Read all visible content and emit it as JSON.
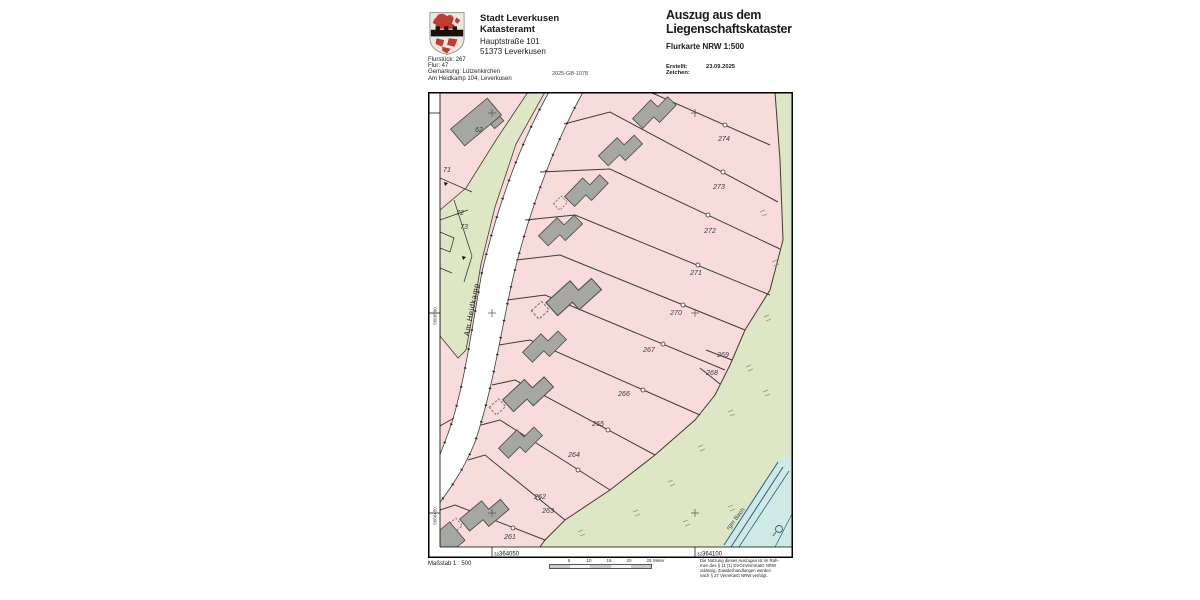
{
  "header": {
    "logo_name": "leverkusen-coat-of-arms",
    "org_line1": "Stadt Leverkusen",
    "org_line2": "Katasteramt",
    "address_line1": "Hauptstraße 101",
    "address_line2": "51373 Leverkusen",
    "info_line1": "Flurstück: 267",
    "info_line2": "Flur: 47",
    "info_line3": "Gemarkung: Lützenkirchen",
    "info_line4": "Am Heidkamp 104, Leverkusen",
    "doc_number": "2025-GB-1078",
    "title_line1": "Auszug aus dem",
    "title_line2": "Liegenschaftskataster",
    "subtitle": "Flurkarte NRW 1:500",
    "created_label": "Erstellt:",
    "created_value": "23.09.2025",
    "reference_label": "Zeichen:"
  },
  "map": {
    "street_label": "Am Heidkamp",
    "stream_label": "rger Bach",
    "parcel_labels": {
      "p62": "62",
      "p71": "71",
      "p72": "72",
      "p73": "73",
      "p274": "274",
      "p273": "273",
      "p272": "272",
      "p271": "271",
      "p270": "270",
      "p269": "269",
      "p268": "268",
      "p267": "267",
      "p266": "266",
      "p265": "265",
      "p264": "264",
      "p262": "262",
      "p263": "263",
      "p261": "261"
    },
    "grid": {
      "x1_prefix": "32",
      "x1": "364050",
      "x2_prefix": "32",
      "x2": "364100",
      "y1": "5666500",
      "y2": "5666450"
    },
    "colors": {
      "parcel_pink": "#f8dcdc",
      "greenland": "#dde7c6",
      "building": "#a5a8a2",
      "boundary": "#433832",
      "water_fill": "#cfe9e4",
      "water_line": "#2b5d8c"
    }
  },
  "footer": {
    "scale_label": "Maßstab 1 : 500",
    "tick1": "5",
    "tick2": "10",
    "tick3": "15",
    "tick4": "20",
    "tick5": "25",
    "unit": "Meter",
    "legal_line1": "Die Nutzung dieses Auszuges ist im Rah-",
    "legal_line2": "men des § 11 (1) DVOzVermKatG NRW",
    "legal_line3": "zulässig. Zuwiderhandlungen werden",
    "legal_line4": "nach § 27 VermKatG NRW verfolgt."
  }
}
